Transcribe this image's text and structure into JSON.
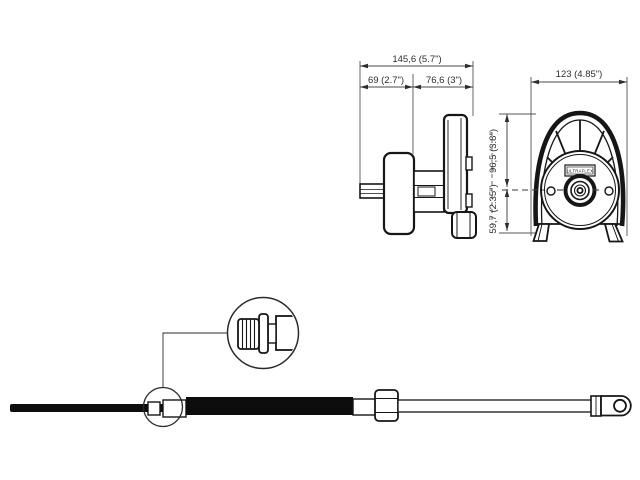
{
  "colors": {
    "background": "#ffffff",
    "line": "#161616",
    "dark_fill": "#0d0d0d",
    "dimension_text": "#2e2e2e"
  },
  "side_view": {
    "overall_width": "145,6 (5.7\")",
    "rear_section": "69 (2.7\")",
    "front_section": "76,6 (3\")"
  },
  "front_view": {
    "overall_width": "123 (4.85\")",
    "center_to_top": "96,5 (3.8\")",
    "center_to_base": "59,7 (2.35\")",
    "brand_plate": "ULTRAFLEX"
  }
}
